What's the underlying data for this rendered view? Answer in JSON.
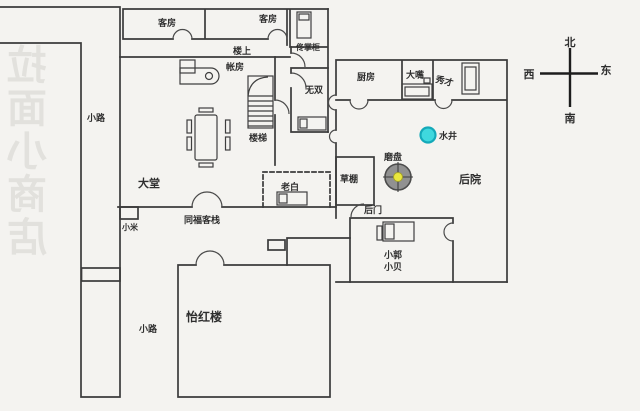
{
  "watermark": {
    "text": "拉面小商店"
  },
  "compass": {
    "north": "北",
    "south": "南",
    "west": "西",
    "east": "东"
  },
  "labels": {
    "guest_room_1": "客房",
    "guest_room_2": "客房",
    "upstairs": "楼上",
    "tong_zhanggui": "佟掌柜",
    "wushuang": "无双",
    "zhangfang": "帐房",
    "stairs": "楼梯",
    "main_hall": "大堂",
    "kitchen": "厨房",
    "dazui": "大嘴",
    "xiucai": "秀才",
    "well": "水井",
    "millstone": "磨盘",
    "backyard": "后院",
    "straw_shed": "草棚",
    "laobai": "老白",
    "inn_sign": "同福客栈",
    "xiaomi": "小米",
    "back_door": "后门",
    "xiaoguo": "小郭",
    "xiaobei": "小贝",
    "yihonglou": "怡红楼",
    "path_upper": "小路",
    "path_lower": "小路"
  },
  "colors": {
    "wall": "#3b3b3b",
    "door": "#4a4a4a",
    "furniture": "#3f3f3f",
    "well_fill": "#3fd8de",
    "well_stroke": "#14a9b9",
    "millstone_fill": "#919191",
    "millstone_stroke": "#4c4c4c",
    "millstone_center_fill": "#eae73e",
    "millstone_center_stroke": "#a3a02a"
  }
}
